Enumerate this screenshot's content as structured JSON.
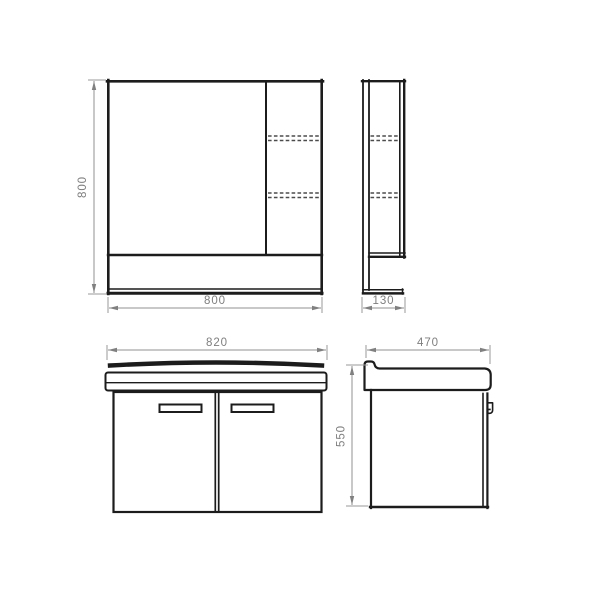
{
  "drawing": {
    "kind": "technical-dimension-drawing",
    "views": {
      "mirror_front": {
        "name": "mirror-cabinet-front-view",
        "height_label": "800",
        "width_label": "800"
      },
      "mirror_side": {
        "name": "mirror-cabinet-side-view",
        "depth_label": "130"
      },
      "cabinet_front": {
        "name": "vanity-cabinet-front-view",
        "width_label": "820"
      },
      "cabinet_side": {
        "name": "vanity-cabinet-side-view",
        "depth_label": "470",
        "height_label": "550"
      }
    },
    "colors": {
      "background": "#ffffff",
      "outline": "#1c1c1c",
      "hidden_line": "#4b4b4b",
      "dimension_line": "#909090",
      "dimension_text": "#7e7e7e"
    }
  }
}
